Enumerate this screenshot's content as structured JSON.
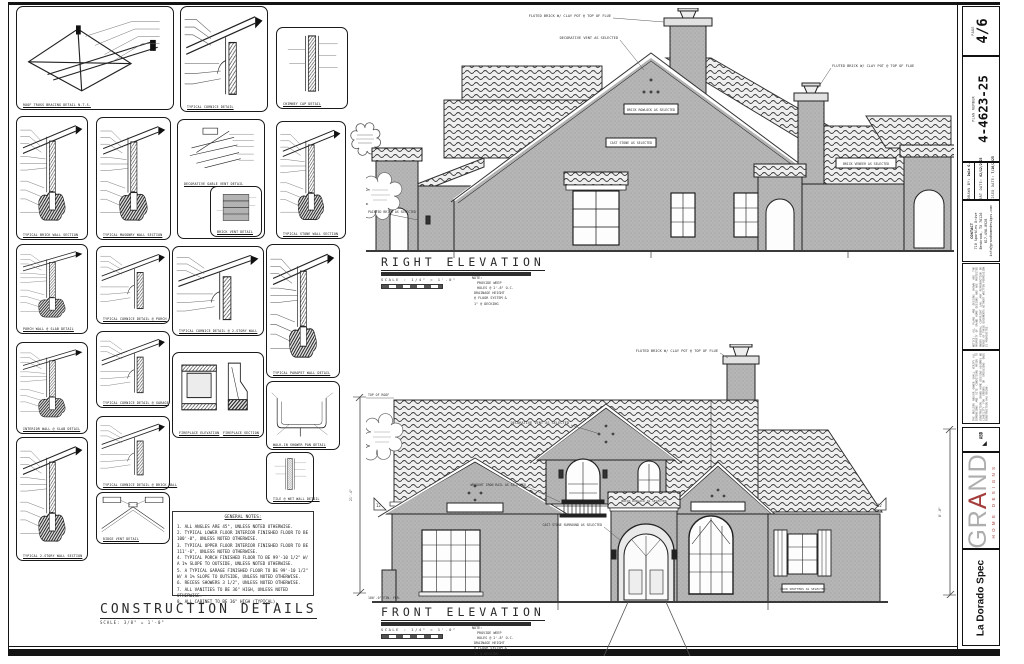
{
  "titleblock": {
    "page": {
      "label": "PAGE",
      "value": "4/6"
    },
    "plan": {
      "label": "PLAN NUMBER",
      "value": "4-4623-25"
    },
    "drawn_by": {
      "label": "DRAWN BY:",
      "value": "Dale G."
    },
    "start_date": {
      "label": "START DATE:",
      "value": "02/12/2025"
    },
    "revised_date": {
      "label": "REVISED DATE:",
      "value": "7/16/2025"
    },
    "contact": {
      "title": "CONTACT",
      "line1": "710 Sparkles Drive",
      "line2": "Benbrook, TX 76126",
      "line3": "817-496-0928",
      "line4": "info@grandhomedesigns.com"
    },
    "disclaimer1": "NOTICE: ALL PLANS AND DESIGNS SHOWN ARE THE PROPERTY OF GRAND HOME DESIGNS AND ARE PROTECTED UNDER FEDERAL COPYRIGHT LAW. ANY REPRODUCTION OR REUSE OF THESE DOCUMENTS WITHOUT WRITTEN PERMISSION IS PROHIBITED.",
    "disclaimer2": "THE BUILDER AND/OR OWNER SHALL VERIFY ALL DIMENSIONS AND SITE CONDITIONS PRIOR TO CONSTRUCTION. GRAND HOME DESIGNS ASSUMES NO LIABILITY FOR ERRORS OR OMISSIONS ONCE CONSTRUCTION HAS BEGUN.",
    "badge": "ABD",
    "logo": {
      "g1": "GR",
      "a": "A",
      "g2": "ND",
      "sub": "HOME DESIGNS"
    },
    "project": "La Dorado Spec"
  },
  "construction_details": {
    "title": "CONSTRUCTION DETAILS",
    "scale": "SCALE: 3/8\" = 1'-0\"",
    "captions": [
      "ROOF TRUSS BRACING DETAIL N.T.S.",
      "TYPICAL CORNICE DETAIL",
      "CHIMNEY CAP DETAIL",
      "TYPICAL BRICK WALL SECTION",
      "TYPICAL MASONRY WALL SECTION",
      "DECORATIVE GABLE VENT DETAIL",
      "BRICK VENT DETAIL",
      "TYPICAL STONE WALL SECTION",
      "PORCH WALL @ SLAB DETAIL",
      "TYPICAL CORNICE DETAIL @ PORCH",
      "TYPICAL PARAPET WALL DETAIL",
      "INTERIOR WALL @ SLAB DETAIL",
      "TYPICAL CORNICE DETAIL @ GARAGE",
      "TYPICAL CORNICE DETAIL @ 2-STORY WALL",
      "FIREPLACE ELEVATION",
      "FIREPLACE SECTION",
      "WALK-IN SHOWER PAN DETAIL",
      "TILE @ WET WALL DETAIL",
      "TYPICAL 2-STORY WALL SECTION",
      "TYPICAL CORNICE DETAIL @ BRICK WALL",
      "RIDGE VENT DETAIL"
    ]
  },
  "general_notes": {
    "title": "GENERAL NOTES:",
    "items": [
      "1. ALL ANGLES ARE 45°, UNLESS NOTED OTHERWISE.",
      "2. TYPICAL LOWER FLOOR INTERIOR FINISHED FLOOR TO BE 100'-0\", UNLESS NOTED OTHERWISE.",
      "3. TYPICAL UPPER FLOOR INTERIOR FINISHED FLOOR TO BE 111'-6\", UNLESS NOTED OTHERWISE.",
      "4. TYPICAL PORCH FINISHED FLOOR TO BE 99'-10 1/2\" W/ A 1% SLOPE TO OUTSIDE, UNLESS NOTED OTHERWISE.",
      "5. A TYPICAL GARAGE FINISHED FLOOR TO BE 99'-10 1/2\" W/ A 1% SLOPE TO OUTSIDE, UNLESS NOTED OTHERWISE.",
      "6. RECESS SHOWERS 3 1/2\", UNLESS NOTED OTHERWISE.",
      "7. ALL VANITIES TO BE 36\" HIGH, UNLESS NOTED OTHERWISE.",
      "8. ALL CABINET TO BE 36\" HIGH (TYPICAL)."
    ]
  },
  "right_elevation": {
    "title": "RIGHT ELEVATION",
    "scale": "SCALE : 1/4\" = 1'-0\"",
    "labels": [
      "FLUTED BRICK W/ CLAY POT @ TOP OF FLUE",
      "DECORATIVE VENT AS SELECTED",
      "FLUTED BRICK W/ CLAY POT @ TOP OF FLUE",
      "BRICK ROWLOCK AS SELECTED",
      "CAST STONE AS SELECTED",
      "PAINTED BRICK AS SELECTED",
      "BRICK VENEER AS SELECTED"
    ]
  },
  "front_elevation": {
    "title": "FRONT ELEVATION",
    "scale": "SCALE : 1/4\" = 1'-0\"",
    "labels": [
      "FLUTED BRICK W/ CLAY POT @ TOP OF FLUE",
      "DECORATIVE VENT AS SELECTED",
      "CAST STONE SURROUND AS SELECTED",
      "WOOD SHUTTERS AS SELECTED",
      "BRICK ROWLOCK AS SELECTED",
      "WROUGHT IRON RAIL AS SELECTED"
    ],
    "top_of_roof": "TOP OF ROOF",
    "fin_floor": "100'-0\" FIN. FLR."
  },
  "elevation_note": {
    "l0": "NOTE:",
    "l1": "PROVIDE WEEP",
    "l2": "HOLES @ 2'-8\" O.C.",
    "l3": "DRAINAGE HEIGHT",
    "l4": "@ FLOOR SYSTEM &",
    "l5": "1\" @ DECKING"
  },
  "dimensions": {
    "details_height": "21'-4\"",
    "front_height": "8'-0\"",
    "pitch": "12"
  }
}
